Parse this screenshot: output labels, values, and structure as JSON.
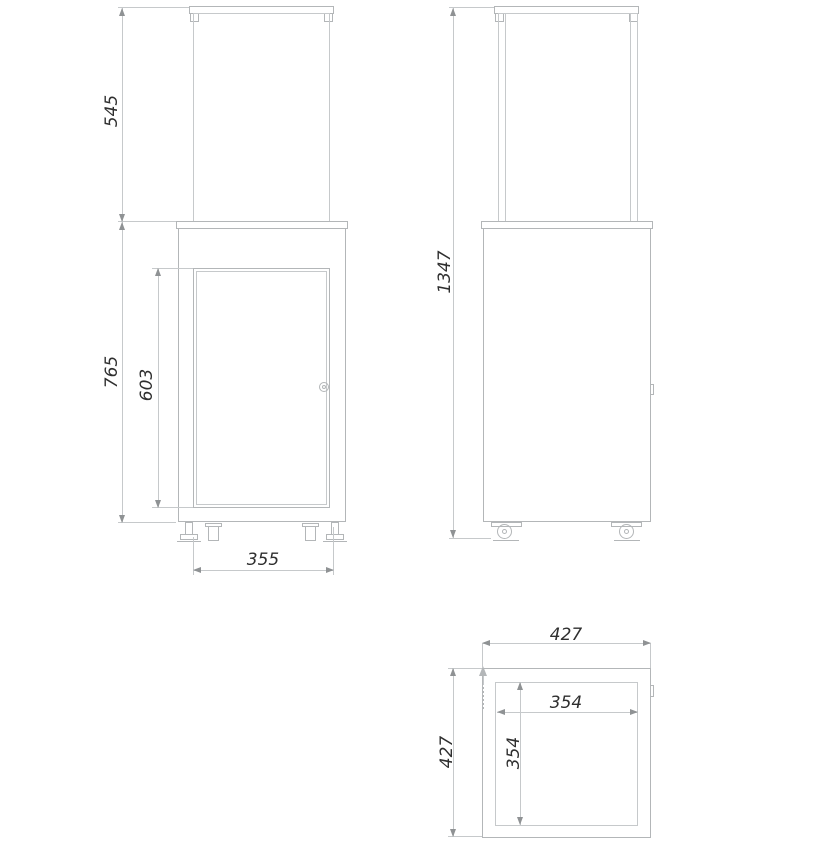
{
  "drawing": {
    "colors": {
      "line": "#b3b6b8",
      "line_light": "#c6c9cb",
      "arrow": "#8f9294",
      "text": "#2f2f2f",
      "background": "#ffffff"
    },
    "views": {
      "front": {
        "dimensions": {
          "glass_height": "545",
          "body_height": "765",
          "door_height": "603",
          "base_width": "355"
        }
      },
      "side": {
        "dimensions": {
          "total_height": "1347"
        }
      },
      "top": {
        "dimensions": {
          "outer_width": "427",
          "outer_depth": "427",
          "inner_width": "354",
          "inner_depth": "354"
        }
      }
    }
  }
}
